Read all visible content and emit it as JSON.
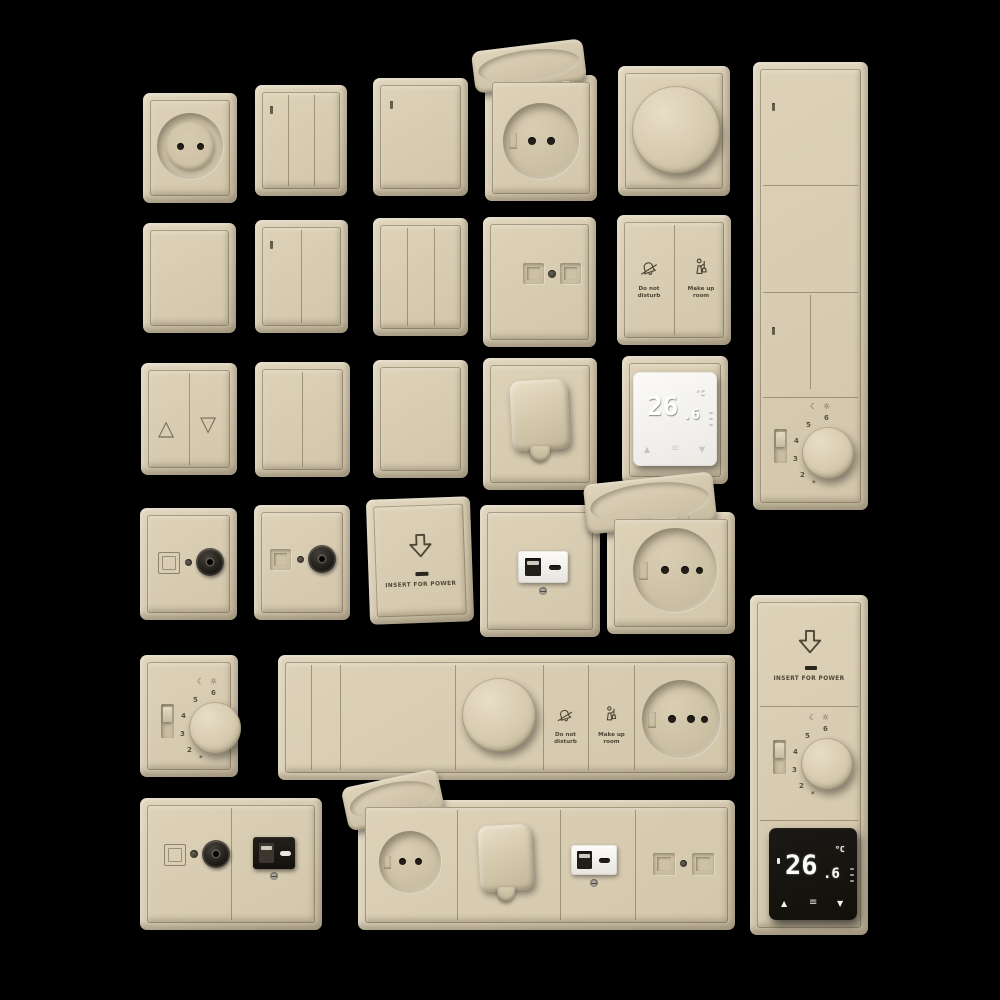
{
  "scene": {
    "background": "#000000",
    "plate_color": "#d6cab0",
    "emboss_color": "#554d3d",
    "display_white": "#f5f4f1",
    "display_black": "#171513"
  },
  "labels": {
    "do_not_disturb_line1": "Do not",
    "do_not_disturb_line2": "disturb",
    "make_up_room_line1": "Make up",
    "make_up_room_line2": "room",
    "insert_for_power": "INSERT FOR POWER"
  },
  "dial": {
    "numbers": [
      "2",
      "3",
      "4",
      "5",
      "6"
    ],
    "moon_symbol": "☾",
    "sun_symbol": "☼",
    "frost_symbol": "*"
  },
  "blinds": {
    "up_symbol": "△",
    "down_symbol": "▽"
  },
  "thermostat_white": {
    "value": "26.6",
    "value_main": "26",
    "value_decimal": ".6",
    "unit": "°C",
    "up_symbol": "▲",
    "down_symbol": "▼",
    "menu_symbol": "≡"
  },
  "thermostat_black": {
    "value": "26.6",
    "value_main": "26",
    "value_decimal": ".6",
    "unit": "°C",
    "up_symbol": "▲",
    "down_symbol": "▼",
    "menu_symbol": "≡"
  }
}
